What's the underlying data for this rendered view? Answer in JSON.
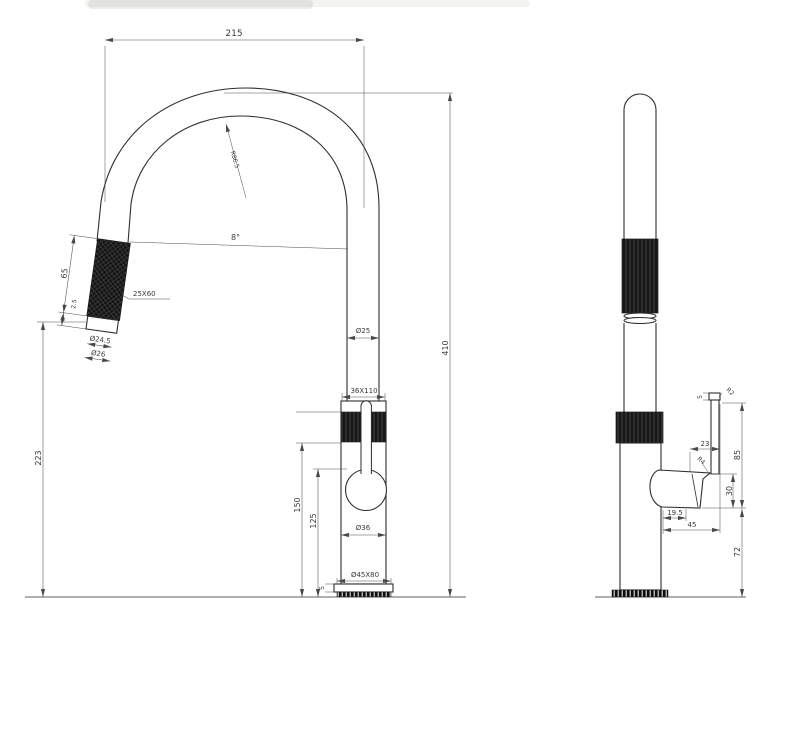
{
  "drawing": {
    "background_color": "#ffffff",
    "line_color": "#3a3a3a",
    "knurl_color": "#161616"
  },
  "front_view": {
    "width_top": "215",
    "bend_radius": "R86.5",
    "head_angle": "8°",
    "head_length": "65",
    "head_tip_offset": "2.5",
    "head_knurl": "25X60",
    "head_outlet_dia": "Ø24.5",
    "head_outer_dia": "Ø26",
    "spout_dia": "Ø25",
    "overall_height": "410",
    "outlet_height": "223",
    "body_knurl": "36X110",
    "body_dia": "Ø36",
    "body_height": "150",
    "loop_height": "125",
    "base_size": "Ø45X80",
    "base_plate_height": "5"
  },
  "side_view": {
    "lever_cap_height": "5",
    "lever_tip_radius": "R2",
    "lever_offset": "23",
    "pivot_radius": "R4",
    "lever_height": "85",
    "cartridge_height": "30",
    "handle_offset": "19.5",
    "handle_reach": "45",
    "handle_ground_clearance": "72"
  }
}
